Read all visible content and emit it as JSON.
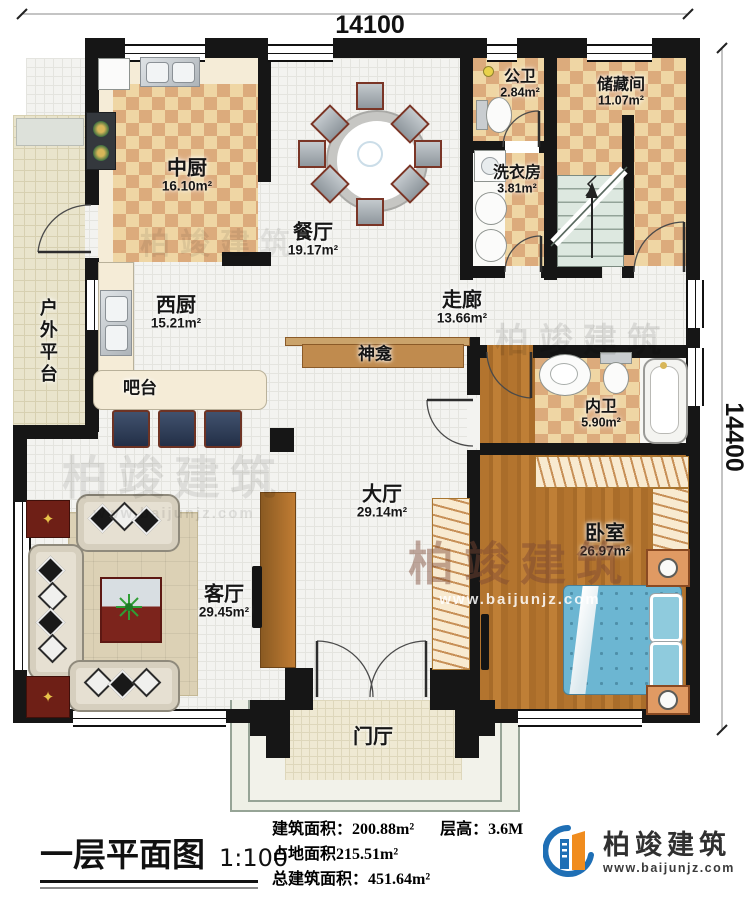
{
  "dimensions": {
    "top": "14100",
    "right": "14400"
  },
  "rooms": {
    "zhongchu": {
      "name": "中厨",
      "area": "16.10m²"
    },
    "canting": {
      "name": "餐厅",
      "area": "19.17m²"
    },
    "gongwei": {
      "name": "公卫",
      "area": "2.84m²"
    },
    "chucang": {
      "name": "储藏间",
      "area": "11.07m²"
    },
    "xiyifang": {
      "name": "洗衣房",
      "area": "3.81m²"
    },
    "xichu": {
      "name": "西厨",
      "area": "15.21m²"
    },
    "zoulang": {
      "name": "走廊",
      "area": "13.66m²"
    },
    "neiwei": {
      "name": "内卫",
      "area": "5.90m²"
    },
    "dating": {
      "name": "大厅",
      "area": "29.14m²"
    },
    "woshi": {
      "name": "卧室",
      "area": "26.97m²"
    },
    "keting": {
      "name": "客厅",
      "area": "29.45m²"
    },
    "menting": {
      "name": "门厅"
    },
    "huwaipingtai": {
      "name": "户外平台"
    },
    "batai": {
      "name": "吧台"
    },
    "shenkan": {
      "name": "神龛"
    }
  },
  "titleblock": {
    "title": "一层平面图",
    "scale": "1:100"
  },
  "info": {
    "build_area_label": "建筑面积：",
    "build_area": "200.88m²",
    "floor_height_label": "层高：",
    "floor_height": "3.6M",
    "land_area": "占地面积215.51m²",
    "total_area_label": "总建筑面积：",
    "total_area": "451.64m²"
  },
  "logo": {
    "name": "柏竣建筑",
    "url": "www.baijunjz.com"
  },
  "watermark": {
    "name": "柏竣建筑",
    "url": "www.baijunjz.com"
  }
}
